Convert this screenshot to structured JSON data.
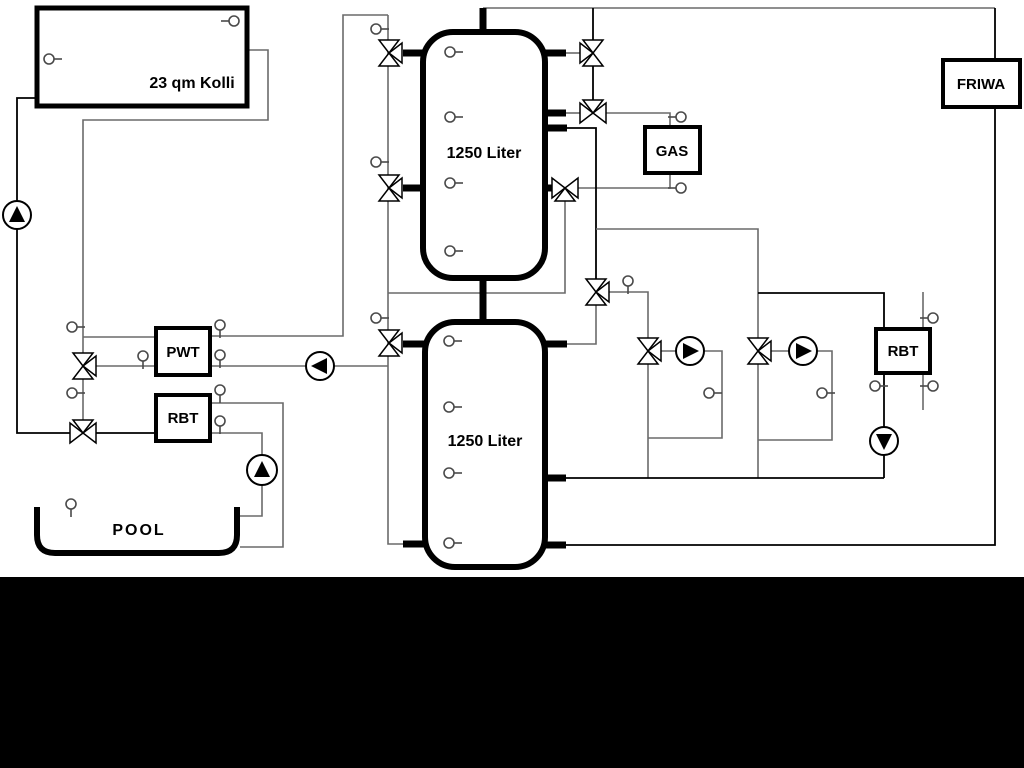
{
  "page": {
    "background": "#ffffff",
    "bottom_band_color": "#000000",
    "bottom_band_top": 577
  },
  "diagram": {
    "width": 1024,
    "height": 768,
    "colors": {
      "pipe": "#6a6a6a",
      "dark_pipe": "#000000",
      "device": "#000000",
      "sensor": "#4a4a4a"
    },
    "boxes": [
      {
        "id": "collector",
        "label": "23 qm Kolli",
        "x": 37,
        "y": 8,
        "w": 210,
        "h": 98,
        "sw": 5,
        "rx": 0,
        "lx": 192,
        "ly": 88,
        "fs": 16
      },
      {
        "id": "tank-top",
        "label": "1250 Liter",
        "x": 423,
        "y": 32,
        "w": 122,
        "h": 246,
        "sw": 6,
        "rx": 30,
        "lx": 484,
        "ly": 158,
        "fs": 16
      },
      {
        "id": "tank-bottom",
        "label": "1250 Liter",
        "x": 425,
        "y": 322,
        "w": 120,
        "h": 245,
        "sw": 6,
        "rx": 30,
        "lx": 485,
        "ly": 446,
        "fs": 16
      },
      {
        "id": "pwt",
        "label": "PWT",
        "x": 156,
        "y": 328,
        "w": 54,
        "h": 47,
        "sw": 4,
        "rx": 0,
        "lx": 183,
        "ly": 357,
        "fs": 15
      },
      {
        "id": "rbt-left",
        "label": "RBT",
        "x": 156,
        "y": 395,
        "w": 54,
        "h": 46,
        "sw": 4,
        "rx": 0,
        "lx": 183,
        "ly": 423,
        "fs": 15
      },
      {
        "id": "gas",
        "label": "GAS",
        "x": 645,
        "y": 127,
        "w": 55,
        "h": 46,
        "sw": 4,
        "rx": 0,
        "lx": 672,
        "ly": 156,
        "fs": 15
      },
      {
        "id": "friwa",
        "label": "FRIWA",
        "x": 943,
        "y": 60,
        "w": 77,
        "h": 47,
        "sw": 4,
        "rx": 0,
        "lx": 981,
        "ly": 89,
        "fs": 15
      },
      {
        "id": "rbt-right",
        "label": "RBT",
        "x": 876,
        "y": 329,
        "w": 54,
        "h": 44,
        "sw": 4,
        "rx": 0,
        "lx": 903,
        "ly": 356,
        "fs": 15
      }
    ],
    "pool": {
      "label": "POOL",
      "lx": 139,
      "ly": 535,
      "fs": 16,
      "path": "M 37 507 L 37 535 Q 37 553 55 553 L 219 553 Q 237 553 237 535 L 237 507"
    },
    "pipes": [
      {
        "pts": [
          [
            38,
            98
          ],
          [
            17,
            98
          ],
          [
            17,
            433
          ],
          [
            70,
            433
          ]
        ],
        "dark": true
      },
      {
        "pts": [
          [
            247,
            50
          ],
          [
            268,
            50
          ],
          [
            268,
            120
          ],
          [
            83,
            120
          ],
          [
            83,
            353
          ]
        ]
      },
      {
        "pts": [
          [
            83,
            337
          ],
          [
            156,
            337
          ]
        ]
      },
      {
        "pts": [
          [
            96,
            366
          ],
          [
            156,
            366
          ]
        ]
      },
      {
        "pts": [
          [
            83,
            379
          ],
          [
            83,
            420
          ]
        ]
      },
      {
        "pts": [
          [
            96,
            433
          ],
          [
            156,
            433
          ]
        ],
        "dark": true
      },
      {
        "pts": [
          [
            210,
            336
          ],
          [
            343,
            336
          ],
          [
            343,
            15
          ],
          [
            388,
            15
          ]
        ]
      },
      {
        "pts": [
          [
            388,
            15
          ],
          [
            388,
            544
          ],
          [
            404,
            544
          ]
        ]
      },
      {
        "pts": [
          [
            210,
            366
          ],
          [
            388,
            366
          ]
        ]
      },
      {
        "pts": [
          [
            210,
            403
          ],
          [
            283,
            403
          ],
          [
            283,
            547
          ],
          [
            240,
            547
          ]
        ]
      },
      {
        "pts": [
          [
            210,
            433
          ],
          [
            262,
            433
          ],
          [
            262,
            516
          ],
          [
            240,
            516
          ]
        ]
      },
      {
        "pts": [
          [
            388,
            293
          ],
          [
            565,
            293
          ],
          [
            565,
            201
          ]
        ]
      },
      {
        "pts": [
          [
            483,
            8
          ],
          [
            995,
            8
          ]
        ]
      },
      {
        "pts": [
          [
            593,
            8
          ],
          [
            593,
            40
          ]
        ],
        "dark": true
      },
      {
        "pts": [
          [
            593,
            66
          ],
          [
            593,
            100
          ]
        ],
        "dark": true
      },
      {
        "pts": [
          [
            566,
            53
          ],
          [
            580,
            53
          ]
        ]
      },
      {
        "pts": [
          [
            566,
            113
          ],
          [
            580,
            113
          ]
        ]
      },
      {
        "pts": [
          [
            606,
            113
          ],
          [
            670,
            113
          ],
          [
            670,
            127
          ]
        ]
      },
      {
        "pts": [
          [
            578,
            188
          ],
          [
            670,
            188
          ],
          [
            670,
            173
          ]
        ]
      },
      {
        "pts": [
          [
            567,
            128
          ],
          [
            596,
            128
          ],
          [
            596,
            279
          ]
        ],
        "dark": true
      },
      {
        "pts": [
          [
            596,
            305
          ],
          [
            596,
            344
          ],
          [
            567,
            344
          ]
        ]
      },
      {
        "pts": [
          [
            596,
            229
          ],
          [
            758,
            229
          ],
          [
            758,
            338
          ]
        ]
      },
      {
        "pts": [
          [
            758,
            293
          ],
          [
            884,
            293
          ],
          [
            884,
            329
          ]
        ],
        "dark": true
      },
      {
        "pts": [
          [
            609,
            292
          ],
          [
            648,
            292
          ],
          [
            648,
            338
          ]
        ]
      },
      {
        "pts": [
          [
            661,
            351
          ],
          [
            722,
            351
          ],
          [
            722,
            438
          ],
          [
            648,
            438
          ]
        ]
      },
      {
        "pts": [
          [
            648,
            364
          ],
          [
            648,
            478
          ]
        ]
      },
      {
        "pts": [
          [
            771,
            351
          ],
          [
            832,
            351
          ],
          [
            832,
            440
          ],
          [
            758,
            440
          ]
        ]
      },
      {
        "pts": [
          [
            758,
            364
          ],
          [
            758,
            478
          ]
        ]
      },
      {
        "pts": [
          [
            884,
            373
          ],
          [
            884,
            478
          ]
        ],
        "dark": true
      },
      {
        "pts": [
          [
            566,
            478
          ],
          [
            884,
            478
          ]
        ],
        "dark": true
      },
      {
        "pts": [
          [
            566,
            545
          ],
          [
            995,
            545
          ],
          [
            995,
            107
          ]
        ],
        "dark": true
      },
      {
        "pts": [
          [
            995,
            8
          ],
          [
            995,
            60
          ]
        ],
        "dark": true
      },
      {
        "pts": [
          [
            923,
            292
          ],
          [
            923,
            410
          ]
        ]
      }
    ],
    "stubs": [
      [
        483,
        8,
        483,
        32
      ],
      [
        483,
        278,
        483,
        322
      ],
      [
        403,
        53,
        424,
        53
      ],
      [
        403,
        188,
        424,
        188
      ],
      [
        545,
        53,
        566,
        53
      ],
      [
        545,
        113,
        566,
        113
      ],
      [
        545,
        128,
        567,
        128
      ],
      [
        545,
        188,
        557,
        188
      ],
      [
        403,
        344,
        425,
        344
      ],
      [
        403,
        544,
        425,
        544
      ],
      [
        545,
        344,
        567,
        344
      ],
      [
        545,
        478,
        566,
        478
      ],
      [
        545,
        545,
        566,
        545
      ]
    ],
    "valves": [
      {
        "x": 389,
        "y": 53,
        "dirs": [
          "N",
          "S",
          "E"
        ]
      },
      {
        "x": 389,
        "y": 188,
        "dirs": [
          "N",
          "S",
          "E"
        ]
      },
      {
        "x": 389,
        "y": 343,
        "dirs": [
          "N",
          "S",
          "E"
        ]
      },
      {
        "x": 83,
        "y": 366,
        "dirs": [
          "N",
          "S",
          "E"
        ]
      },
      {
        "x": 83,
        "y": 433,
        "dirs": [
          "W",
          "E",
          "N"
        ]
      },
      {
        "x": 593,
        "y": 53,
        "dirs": [
          "N",
          "S",
          "W"
        ]
      },
      {
        "x": 593,
        "y": 113,
        "dirs": [
          "N",
          "W",
          "E"
        ]
      },
      {
        "x": 565,
        "y": 188,
        "dirs": [
          "W",
          "E",
          "S"
        ]
      },
      {
        "x": 596,
        "y": 292,
        "dirs": [
          "N",
          "S",
          "E"
        ]
      },
      {
        "x": 648,
        "y": 351,
        "dirs": [
          "N",
          "S",
          "E"
        ]
      },
      {
        "x": 758,
        "y": 351,
        "dirs": [
          "N",
          "S",
          "E"
        ]
      }
    ],
    "pumps": [
      {
        "x": 17,
        "y": 215,
        "dir": "up",
        "r": 14
      },
      {
        "x": 320,
        "y": 366,
        "dir": "left",
        "r": 14
      },
      {
        "x": 262,
        "y": 470,
        "dir": "up",
        "r": 15
      },
      {
        "x": 690,
        "y": 351,
        "dir": "right",
        "r": 14
      },
      {
        "x": 803,
        "y": 351,
        "dir": "right",
        "r": 14
      },
      {
        "x": 884,
        "y": 441,
        "dir": "down",
        "r": 14
      }
    ],
    "sensors": [
      {
        "x": 234,
        "y": 21,
        "stem": "left"
      },
      {
        "x": 49,
        "y": 59,
        "stem": "right"
      },
      {
        "x": 450,
        "y": 52,
        "stem": "right"
      },
      {
        "x": 450,
        "y": 117,
        "stem": "right"
      },
      {
        "x": 450,
        "y": 183,
        "stem": "right"
      },
      {
        "x": 450,
        "y": 251,
        "stem": "right"
      },
      {
        "x": 449,
        "y": 341,
        "stem": "right"
      },
      {
        "x": 449,
        "y": 407,
        "stem": "right"
      },
      {
        "x": 449,
        "y": 473,
        "stem": "right"
      },
      {
        "x": 449,
        "y": 543,
        "stem": "right"
      },
      {
        "x": 376,
        "y": 29,
        "stem": "right"
      },
      {
        "x": 376,
        "y": 162,
        "stem": "right"
      },
      {
        "x": 376,
        "y": 318,
        "stem": "right"
      },
      {
        "x": 72,
        "y": 327,
        "stem": "right"
      },
      {
        "x": 72,
        "y": 393,
        "stem": "right"
      },
      {
        "x": 143,
        "y": 356,
        "stem": "down"
      },
      {
        "x": 220,
        "y": 325,
        "stem": "down"
      },
      {
        "x": 220,
        "y": 355,
        "stem": "down"
      },
      {
        "x": 220,
        "y": 390,
        "stem": "down"
      },
      {
        "x": 220,
        "y": 421,
        "stem": "down"
      },
      {
        "x": 71,
        "y": 504,
        "stem": "down"
      },
      {
        "x": 681,
        "y": 117,
        "stem": "left"
      },
      {
        "x": 681,
        "y": 188,
        "stem": "left"
      },
      {
        "x": 628,
        "y": 281,
        "stem": "down"
      },
      {
        "x": 709,
        "y": 393,
        "stem": "right"
      },
      {
        "x": 822,
        "y": 393,
        "stem": "right"
      },
      {
        "x": 875,
        "y": 386,
        "stem": "right"
      },
      {
        "x": 933,
        "y": 318,
        "stem": "left"
      },
      {
        "x": 933,
        "y": 386,
        "stem": "left"
      }
    ]
  }
}
